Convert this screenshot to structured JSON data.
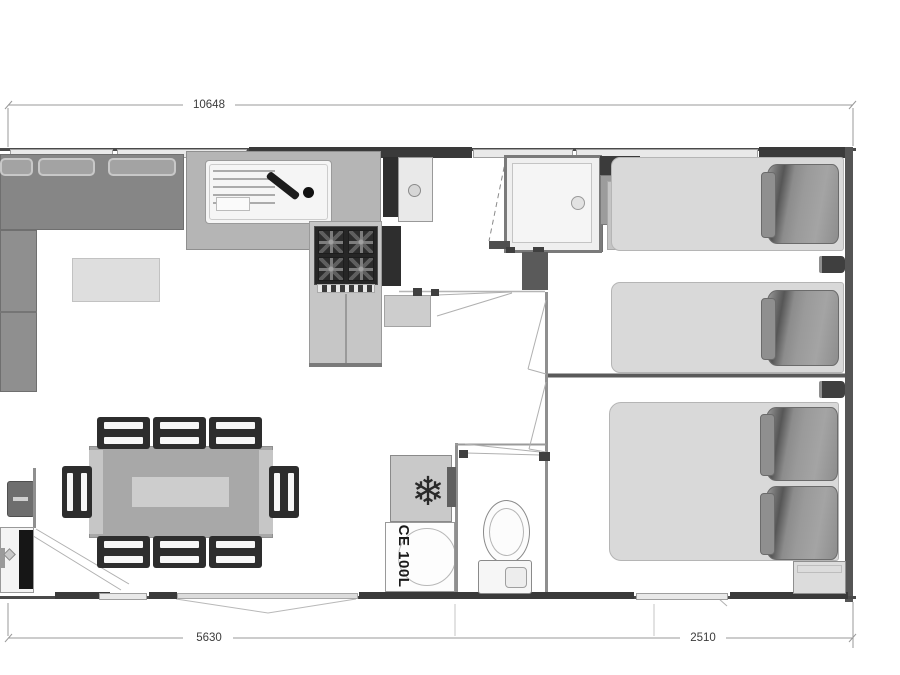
{
  "floorplan": {
    "dimensions": {
      "overall_width": "10648",
      "living_section_width": "5630",
      "master_section_width": "2510"
    },
    "appliances": {
      "water_heater_label": "CE 100L"
    },
    "icons": {
      "fridge_snowflake": "❄"
    },
    "colors": {
      "wall": "#3f3f3f",
      "furniture_dark": "#2d2d2d",
      "furniture_mid": "#8f8f8f",
      "bed_light": "#d9d9d9",
      "dimension_line": "#9a9a9a",
      "background": "#ffffff"
    }
  }
}
